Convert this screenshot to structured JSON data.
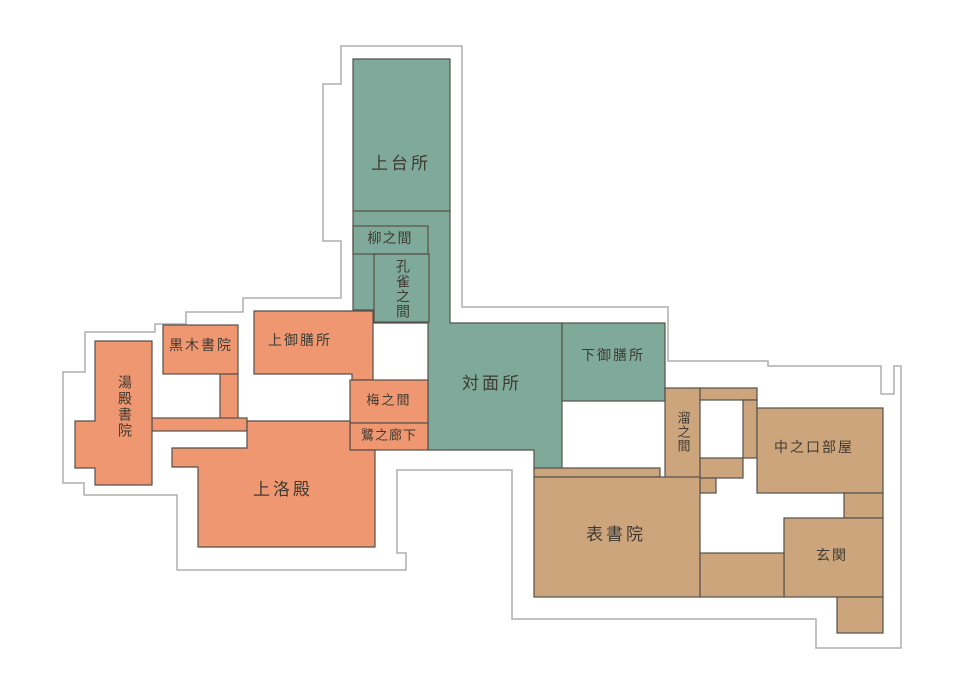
{
  "figure": {
    "type": "floor-plan",
    "description_visible_text_only": ""
  },
  "colors": {
    "green": "#7fa99b",
    "orange": "#ef9770",
    "tan": "#cda57c",
    "room_border": "#55514a",
    "outline": "#aeaeae",
    "label_text": "#3f3b33",
    "background": "#ffffff"
  },
  "rooms": [
    {
      "id": "kamidaidokoro",
      "label": "上台所",
      "color": "green",
      "orientation": "horizontal"
    },
    {
      "id": "yanaginoma",
      "label": "柳之間",
      "color": "green",
      "orientation": "horizontal"
    },
    {
      "id": "kujakunoma",
      "label": "孔雀之間",
      "color": "green",
      "orientation": "vertical"
    },
    {
      "id": "taimenjo",
      "label": "対面所",
      "color": "green",
      "orientation": "horizontal"
    },
    {
      "id": "shimogozensho",
      "label": "下御膳所",
      "color": "green",
      "orientation": "horizontal"
    },
    {
      "id": "kurokishoin",
      "label": "黒木書院",
      "color": "orange",
      "orientation": "horizontal"
    },
    {
      "id": "kamigozensho",
      "label": "上御膳所",
      "color": "orange",
      "orientation": "horizontal"
    },
    {
      "id": "yudonoshoin",
      "label": "湯殿書院",
      "color": "orange",
      "orientation": "vertical"
    },
    {
      "id": "umenoma",
      "label": "梅之間",
      "color": "orange",
      "orientation": "horizontal"
    },
    {
      "id": "saginoroka",
      "label": "鷺之廊下",
      "color": "orange",
      "orientation": "horizontal"
    },
    {
      "id": "jorakuden",
      "label": "上洛殿",
      "color": "orange",
      "orientation": "horizontal"
    },
    {
      "id": "tamarinoma",
      "label": "溜之間",
      "color": "tan",
      "orientation": "vertical"
    },
    {
      "id": "nakanokuchibeya",
      "label": "中之口部屋",
      "color": "tan",
      "orientation": "horizontal"
    },
    {
      "id": "omoteshoin",
      "label": "表書院",
      "color": "tan",
      "orientation": "horizontal"
    },
    {
      "id": "genkan",
      "label": "玄関",
      "color": "tan",
      "orientation": "horizontal"
    }
  ]
}
